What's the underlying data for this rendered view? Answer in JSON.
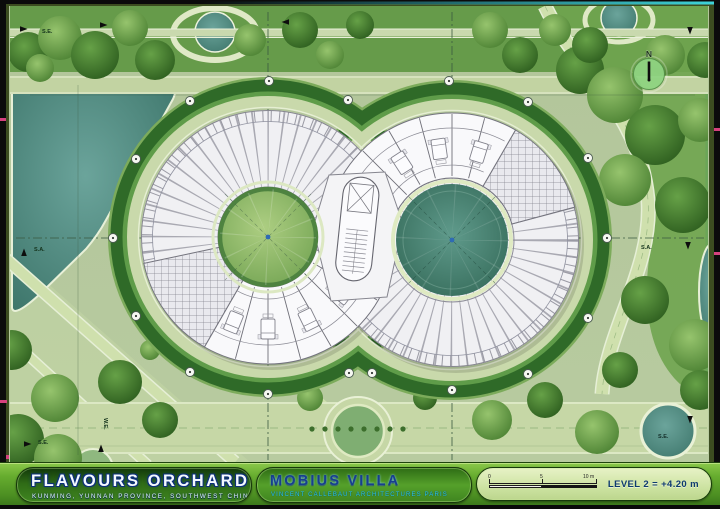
{
  "plan": {
    "labels": {
      "nw": "S.E.",
      "west": "S.A.",
      "east": "S.A.",
      "sw_vertical": "W.E.",
      "sw": "S.E.",
      "se": "S.E."
    },
    "north_label": "N"
  },
  "titlebar": {
    "project_title": "FLAVOURS ORCHARD",
    "project_subtitle": "KUNMING, YUNNAN PROVINCE, SOUTHWEST CHINA",
    "drawing_title": "MOBIUS VILLA",
    "drawing_subtitle": "VINCENT CALLEBAUT ARCHITECTURES PARIS",
    "level_label": "LEVEL 2 = +4.20 m",
    "scale_ticks": [
      "0",
      "5",
      "10 m"
    ]
  },
  "colors": {
    "accent_green": "#67ad2f",
    "pond_teal": "#4f8d82",
    "title_navy": "#173f8e",
    "frame_cyan": "#35c8d2"
  }
}
